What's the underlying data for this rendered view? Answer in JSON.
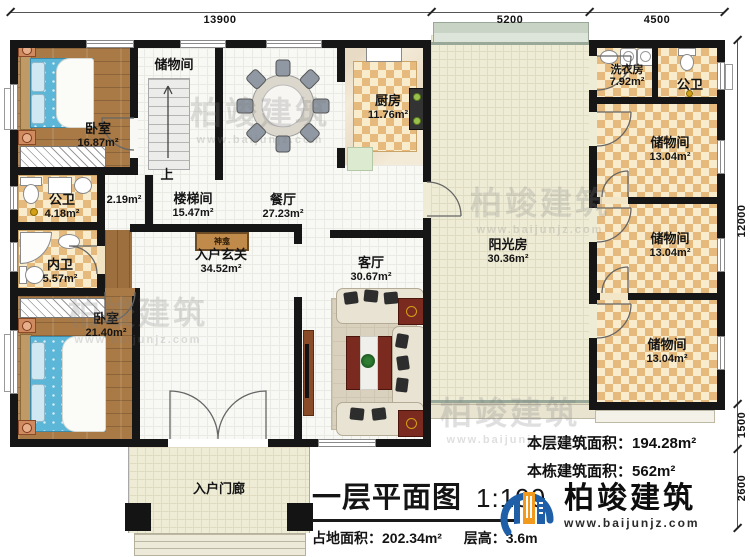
{
  "dims": {
    "top1": "13900",
    "top2": "5200",
    "top3": "4500",
    "right1": "12000",
    "right2": "1500",
    "right3": "2600"
  },
  "rooms": {
    "bedroom_top": {
      "name": "卧室",
      "area": "16.87m²"
    },
    "storage_hall": {
      "name": "储物间"
    },
    "dining": {
      "name": "餐厅",
      "area": "27.23m²"
    },
    "kitchen": {
      "name": "厨房",
      "area": "11.76m²"
    },
    "stairwell": {
      "name": "楼梯间",
      "area": "15.47m²",
      "up": "上",
      "closet_area": "2.19m²"
    },
    "bath_left": {
      "name": "公卫",
      "area": "4.18m²"
    },
    "bath_inner": {
      "name": "内卫",
      "area": "5.57m²"
    },
    "bedroom_bottom": {
      "name": "卧室",
      "area": "21.40m²"
    },
    "foyer": {
      "name": "入户玄关",
      "area": "34.52m²"
    },
    "shrine": {
      "name": "神龛"
    },
    "living": {
      "name": "客厅",
      "area": "30.67m²"
    },
    "sunroom": {
      "name": "阳光房",
      "area": "30.36m²"
    },
    "laundry": {
      "name": "洗衣房",
      "area": "7.92m²"
    },
    "bath_right": {
      "name": "公卫"
    },
    "storage1": {
      "name": "储物间",
      "area": "13.04m²"
    },
    "storage2": {
      "name": "储物间",
      "area": "13.04m²"
    },
    "storage3": {
      "name": "储物间",
      "area": "13.04m²"
    },
    "porch": {
      "name": "入户门廊"
    }
  },
  "stats": {
    "floor_area_label": "本层建筑面积：",
    "floor_area_value": "194.28m²",
    "building_area_label": "本栋建筑面积：",
    "building_area_value": "562m²"
  },
  "titleblock": {
    "title": "一层平面图",
    "scale": "1:100",
    "footprint_label": "占地面积：",
    "footprint_value": "202.34m²",
    "height_label": "层高：",
    "height_value": "3.6m"
  },
  "logo": {
    "company": "柏竣建筑",
    "website": "www.baijunjz.com"
  },
  "watermark": {
    "line1": "柏竣建筑",
    "line2": "www.baijunjz.com"
  },
  "colors": {
    "wall": "#161616",
    "wood": "#a97a45",
    "checker_dark": "#e5ba7c",
    "checker_light": "#f8eccd",
    "sun_tile": "#efecd6",
    "logo_blue": "#1f5fa8",
    "logo_orange": "#f29a1e"
  }
}
